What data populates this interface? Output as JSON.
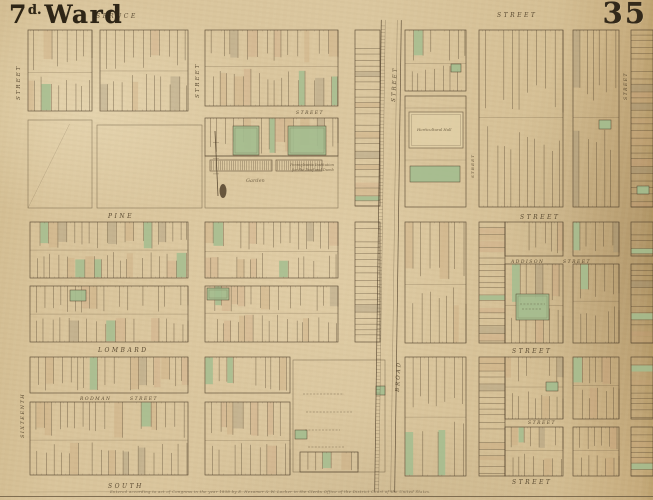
{
  "map": {
    "ward_title": {
      "number": "7",
      "superscript": "d.",
      "word": "Ward"
    },
    "plate_number": "35",
    "credit_line": "Entered according to act of Congress in the year 1858 by E. Hexamer & W. Locher in the Clerks Office of the District Court of the United States.",
    "colors": {
      "paper": "#d8c298",
      "ink": "#4a3a26",
      "label": "#44351f",
      "lot_green": "#a3bd8f",
      "wash": "#c7a377"
    },
    "street_labels": [
      {
        "text": "SPRUCE",
        "x": 96,
        "y": 18,
        "size": 6,
        "sp": 2.5
      },
      {
        "text": "STREET",
        "x": 497,
        "y": 17,
        "size": 6,
        "sp": 2.5
      },
      {
        "text": "PINE",
        "x": 108,
        "y": 218,
        "size": 6,
        "sp": 2.5
      },
      {
        "text": "STREET",
        "x": 520,
        "y": 219,
        "size": 6,
        "sp": 2.5
      },
      {
        "text": "LOMBARD",
        "x": 98,
        "y": 352,
        "size": 6,
        "sp": 2.5
      },
      {
        "text": "STREET",
        "x": 512,
        "y": 353,
        "size": 6,
        "sp": 2.5
      },
      {
        "text": "SOUTH",
        "x": 108,
        "y": 488,
        "size": 6,
        "sp": 2.5
      },
      {
        "text": "STREET",
        "x": 512,
        "y": 484,
        "size": 6,
        "sp": 2.5
      },
      {
        "text": "ADDISON",
        "x": 511,
        "y": 263,
        "size": 4.5,
        "sp": 1.5
      },
      {
        "text": "STREET",
        "x": 563,
        "y": 263,
        "size": 4.5,
        "sp": 1.5
      },
      {
        "text": "RODMAN",
        "x": 80,
        "y": 400,
        "size": 4.5,
        "sp": 1.5
      },
      {
        "text": "STREET",
        "x": 130,
        "y": 400,
        "size": 4.5,
        "sp": 1.5
      },
      {
        "text": "STREET",
        "x": 296,
        "y": 114,
        "size": 4.5,
        "sp": 1.5
      },
      {
        "text": "STREET",
        "x": 528,
        "y": 424,
        "size": 4.5,
        "sp": 1.5
      },
      {
        "text": "STREET",
        "x": 20,
        "y": 100,
        "size": 5.5,
        "sp": 2,
        "rot": -90
      },
      {
        "text": "SIXTEENTH",
        "x": 24,
        "y": 438,
        "size": 5,
        "sp": 1.5,
        "rot": -90
      },
      {
        "text": "STREET",
        "x": 199,
        "y": 98,
        "size": 5.5,
        "sp": 2,
        "rot": -90
      },
      {
        "text": "STREET",
        "x": 395,
        "y": 102,
        "size": 5.5,
        "sp": 2,
        "rot": -87
      },
      {
        "text": "BROAD",
        "x": 399,
        "y": 392,
        "size": 5.5,
        "sp": 2,
        "rot": -87
      },
      {
        "text": "STREET",
        "x": 474,
        "y": 178,
        "size": 4,
        "sp": 1.2,
        "rot": -90
      },
      {
        "text": "STREET",
        "x": 627,
        "y": 100,
        "size": 4.5,
        "sp": 1.5,
        "rot": -90
      }
    ],
    "annotations": [
      {
        "text": "Pennsylvania Institution",
        "x": 290,
        "y": 166,
        "size": 3.6
      },
      {
        "text": "for the Deaf and Dumb",
        "x": 292,
        "y": 171,
        "size": 3.6
      },
      {
        "text": "Garden",
        "x": 246,
        "y": 182,
        "size": 5
      },
      {
        "text": "Horticultural Hall",
        "x": 417,
        "y": 131,
        "size": 3.8
      }
    ],
    "blocks": [
      {
        "x": 28,
        "y": 30,
        "w": 64,
        "h": 81,
        "kind": "lots",
        "seed": 11
      },
      {
        "x": 100,
        "y": 30,
        "w": 88,
        "h": 81,
        "kind": "lots",
        "seed": 12
      },
      {
        "x": 205,
        "y": 30,
        "w": 133,
        "h": 76,
        "kind": "lots",
        "seed": 13
      },
      {
        "x": 355,
        "y": 30,
        "w": 25,
        "h": 176,
        "kind": "lotsH",
        "seed": 14
      },
      {
        "x": 28,
        "y": 120,
        "w": 64,
        "h": 88,
        "kind": "open",
        "diag": true
      },
      {
        "x": 97,
        "y": 125,
        "w": 105,
        "h": 83,
        "kind": "open"
      },
      {
        "x": 205,
        "y": 118,
        "w": 133,
        "h": 38,
        "kind": "lots",
        "seed": 15
      },
      {
        "x": 205,
        "y": 156,
        "w": 133,
        "h": 52,
        "kind": "open"
      },
      {
        "x": 30,
        "y": 222,
        "w": 158,
        "h": 56,
        "kind": "lots",
        "seed": 16
      },
      {
        "x": 30,
        "y": 286,
        "w": 158,
        "h": 56,
        "kind": "lots",
        "seed": 17
      },
      {
        "x": 205,
        "y": 222,
        "w": 133,
        "h": 56,
        "kind": "lots",
        "seed": 18
      },
      {
        "x": 205,
        "y": 286,
        "w": 133,
        "h": 56,
        "kind": "lots",
        "seed": 19
      },
      {
        "x": 355,
        "y": 222,
        "w": 25,
        "h": 120,
        "kind": "lotsH",
        "seed": 20
      },
      {
        "x": 30,
        "y": 357,
        "w": 158,
        "h": 36,
        "kind": "lots",
        "seed": 21
      },
      {
        "x": 30,
        "y": 402,
        "w": 158,
        "h": 73,
        "kind": "lots",
        "seed": 22
      },
      {
        "x": 205,
        "y": 357,
        "w": 85,
        "h": 36,
        "kind": "lots",
        "seed": 23
      },
      {
        "x": 205,
        "y": 402,
        "w": 85,
        "h": 73,
        "kind": "lots",
        "seed": 24
      },
      {
        "x": 293,
        "y": 360,
        "w": 92,
        "h": 112,
        "kind": "open"
      },
      {
        "x": 300,
        "y": 452,
        "w": 58,
        "h": 20,
        "kind": "lots",
        "seed": 25
      },
      {
        "x": 405,
        "y": 30,
        "w": 61,
        "h": 61,
        "kind": "lots",
        "seed": 26
      },
      {
        "x": 479,
        "y": 30,
        "w": 84,
        "h": 177,
        "kind": "lots",
        "seed": 27
      },
      {
        "x": 573,
        "y": 30,
        "w": 46,
        "h": 177,
        "kind": "lots",
        "seed": 28
      },
      {
        "x": 631,
        "y": 30,
        "w": 22,
        "h": 177,
        "kind": "lotsH",
        "seed": 29
      },
      {
        "x": 405,
        "y": 222,
        "w": 61,
        "h": 121,
        "kind": "lots",
        "seed": 30
      },
      {
        "x": 479,
        "y": 222,
        "w": 26,
        "h": 121,
        "kind": "lotsH",
        "seed": 31
      },
      {
        "x": 505,
        "y": 222,
        "w": 58,
        "h": 34,
        "kind": "lots",
        "seed": 32
      },
      {
        "x": 505,
        "y": 264,
        "w": 58,
        "h": 79,
        "kind": "lots",
        "seed": 33
      },
      {
        "x": 573,
        "y": 222,
        "w": 46,
        "h": 34,
        "kind": "lots",
        "seed": 34
      },
      {
        "x": 573,
        "y": 264,
        "w": 46,
        "h": 79,
        "kind": "lots",
        "seed": 35
      },
      {
        "x": 631,
        "y": 222,
        "w": 22,
        "h": 34,
        "kind": "lotsH",
        "seed": 36
      },
      {
        "x": 631,
        "y": 264,
        "w": 22,
        "h": 79,
        "kind": "lotsH",
        "seed": 37
      },
      {
        "x": 405,
        "y": 357,
        "w": 61,
        "h": 119,
        "kind": "lots",
        "seed": 38
      },
      {
        "x": 479,
        "y": 357,
        "w": 26,
        "h": 119,
        "kind": "lotsH",
        "seed": 39
      },
      {
        "x": 505,
        "y": 357,
        "w": 58,
        "h": 62,
        "kind": "lots",
        "seed": 40
      },
      {
        "x": 505,
        "y": 427,
        "w": 58,
        "h": 49,
        "kind": "lots",
        "seed": 41
      },
      {
        "x": 573,
        "y": 357,
        "w": 46,
        "h": 62,
        "kind": "lots",
        "seed": 42
      },
      {
        "x": 573,
        "y": 427,
        "w": 46,
        "h": 49,
        "kind": "lots",
        "seed": 43
      },
      {
        "x": 631,
        "y": 357,
        "w": 22,
        "h": 62,
        "kind": "lotsH",
        "seed": 44
      },
      {
        "x": 631,
        "y": 427,
        "w": 22,
        "h": 49,
        "kind": "lotsH",
        "seed": 45
      }
    ],
    "campus": {
      "x": 405,
      "y": 96,
      "w": 61,
      "h": 111,
      "bldg": {
        "x": 409,
        "y": 112,
        "w": 54,
        "h": 36
      },
      "green": {
        "x": 410,
        "y": 166,
        "w": 50,
        "h": 16
      }
    },
    "greens": [
      {
        "x": 233,
        "y": 126,
        "w": 26,
        "h": 29
      },
      {
        "x": 288,
        "y": 126,
        "w": 38,
        "h": 29
      },
      {
        "x": 516,
        "y": 294,
        "w": 33,
        "h": 26
      },
      {
        "x": 70,
        "y": 290,
        "w": 16,
        "h": 11
      },
      {
        "x": 207,
        "y": 288,
        "w": 22,
        "h": 12
      },
      {
        "x": 376,
        "y": 386,
        "w": 9,
        "h": 9
      },
      {
        "x": 295,
        "y": 430,
        "w": 12,
        "h": 9
      },
      {
        "x": 599,
        "y": 120,
        "w": 12,
        "h": 9
      },
      {
        "x": 637,
        "y": 186,
        "w": 12,
        "h": 8
      },
      {
        "x": 546,
        "y": 382,
        "w": 12,
        "h": 9
      },
      {
        "x": 451,
        "y": 64,
        "w": 10,
        "h": 8
      }
    ],
    "hatched_buildings": [
      {
        "x": 210,
        "y": 160,
        "w": 62,
        "h": 11
      },
      {
        "x": 276,
        "y": 160,
        "w": 46,
        "h": 11
      }
    ],
    "broad_street": {
      "x1": 381,
      "x2": 401,
      "y1": 20,
      "y2": 492,
      "tilt": 0.8
    },
    "flagpole": {
      "x": 215,
      "top": 131,
      "bottom": 196,
      "blob_x": 223,
      "blob_y": 191
    },
    "faint_lines": [
      {
        "x1": 303,
        "y1": 394,
        "x2": 344,
        "y2": 394
      },
      {
        "x1": 306,
        "y1": 412,
        "x2": 352,
        "y2": 412
      },
      {
        "x1": 305,
        "y1": 430,
        "x2": 340,
        "y2": 430
      },
      {
        "x1": 308,
        "y1": 447,
        "x2": 345,
        "y2": 447
      },
      {
        "x1": 520,
        "y1": 304,
        "x2": 545,
        "y2": 304
      },
      {
        "x1": 522,
        "y1": 309,
        "x2": 542,
        "y2": 309
      }
    ],
    "bottom_rule_y": 496.5
  }
}
